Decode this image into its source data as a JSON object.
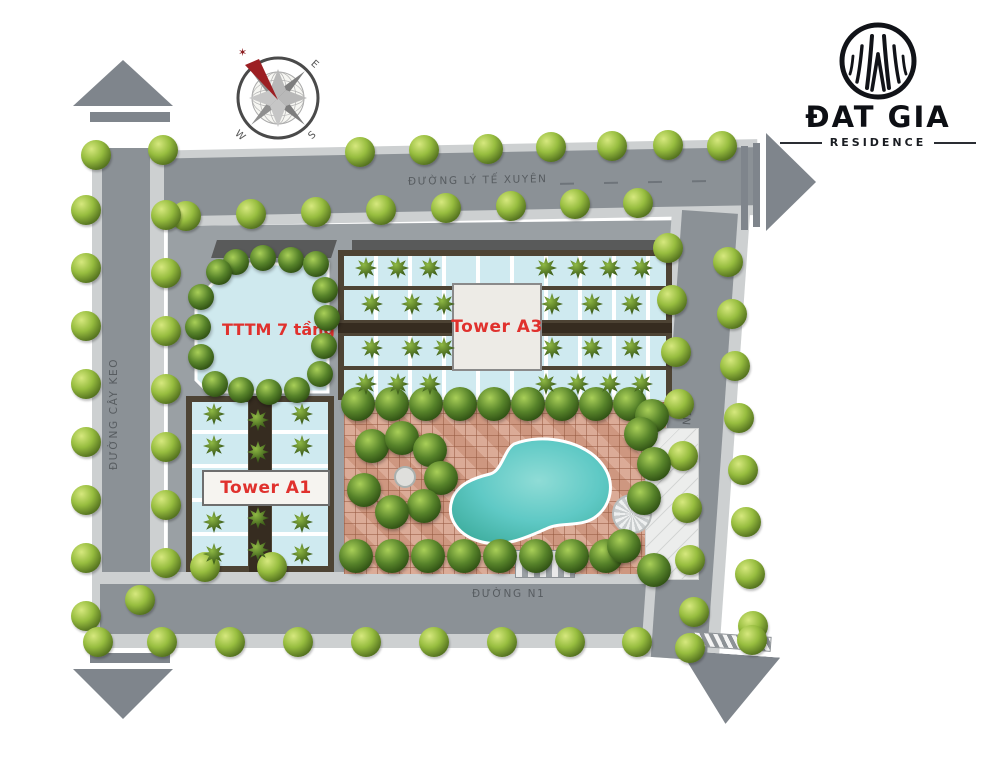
{
  "site": {
    "brand": "ĐAT GIA",
    "subtitle": "RESIDENCE"
  },
  "compass": {
    "east": "E",
    "south": "S",
    "west": "W"
  },
  "roads": {
    "top": {
      "label": "ĐƯỜNG LÝ TẾ XUYÊN"
    },
    "left": {
      "label": "ĐƯỜNG CÂY KEO"
    },
    "right": {
      "label": "ĐƯỜNG N2"
    },
    "bottom": {
      "label": "ĐƯỜNG N1"
    }
  },
  "buildings": {
    "tttm": {
      "label": "TTTM 7 tầng"
    },
    "tower_a3": {
      "label": "Tower A3"
    },
    "tower_a1": {
      "label": "Tower A1"
    }
  },
  "colors": {
    "road": "#8b9196",
    "sidewalk": "#cdd0d1",
    "arrow": "#7f858c",
    "ground": "#9aa0a4",
    "building_glass": "#cfeaf0",
    "corridor_brown": "#4d4334",
    "tile_plaza": "#d7a28b",
    "pool_water": "#5fc9c5",
    "label_red": "#e0312d",
    "tree_green": "#57832a"
  }
}
